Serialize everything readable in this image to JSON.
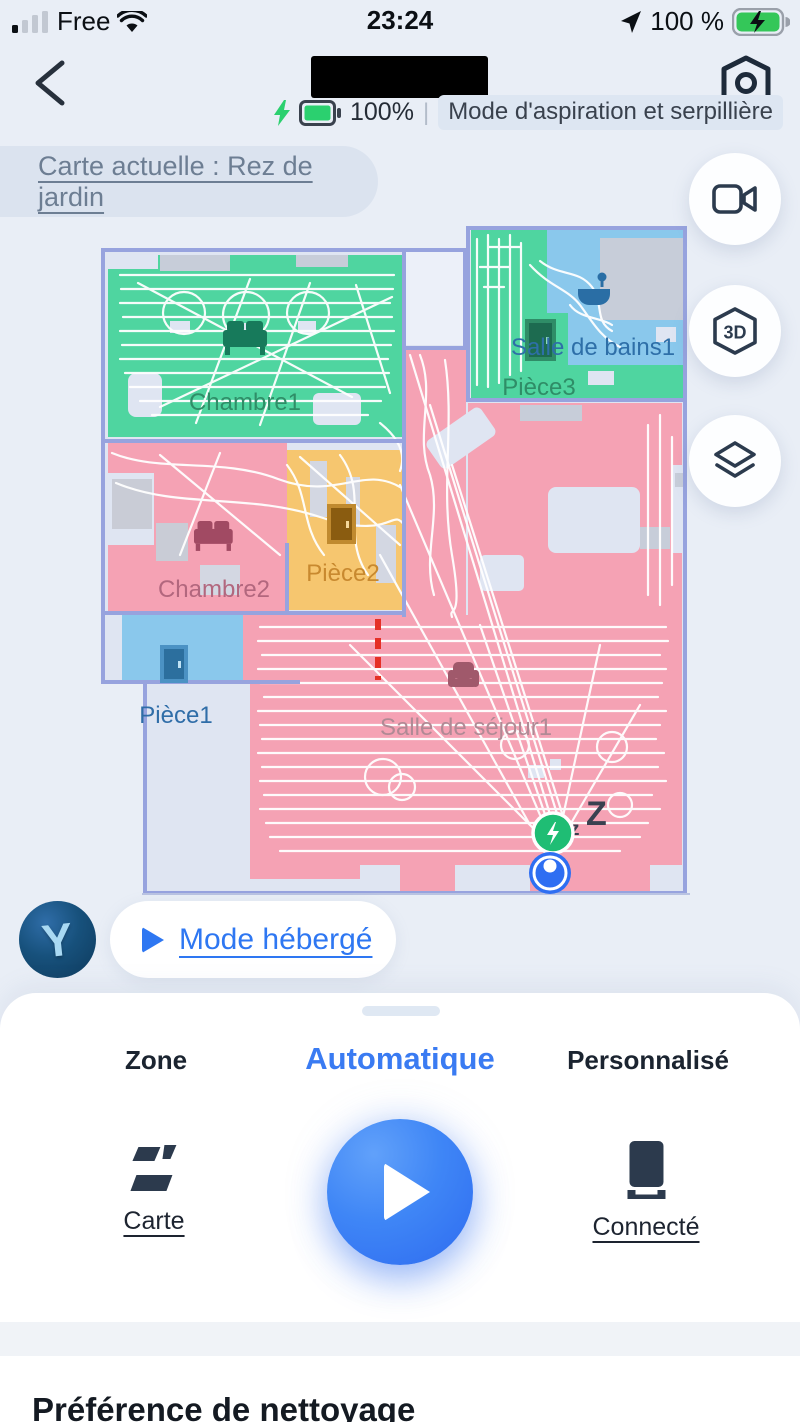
{
  "status_bar": {
    "carrier": "Free",
    "time": "23:24",
    "battery_percent": "100 %"
  },
  "device_header": {
    "battery_label": "100%",
    "mode_label": "Mode d'aspiration et serpillière"
  },
  "map_bar": {
    "current_map_label": "Carte actuelle : Rez de jardin"
  },
  "map": {
    "rooms": [
      {
        "name": "Chambre1",
        "label_color": "#2f8d67",
        "fill": "#4fd5a0"
      },
      {
        "name": "Salle de bains1",
        "label_color": "#2e6fa8",
        "fill": "#8ac8ec"
      },
      {
        "name": "Pièce3",
        "label_color": "#2f8d67",
        "fill": "#4fd5a0"
      },
      {
        "name": "Chambre2",
        "label_color": "#b2677e",
        "fill": "#f5a2b4"
      },
      {
        "name": "Pièce2",
        "label_color": "#c8892f",
        "fill": "#f6c66f"
      },
      {
        "name": "Pièce1",
        "label_color": "#2f6da8",
        "fill": "#8ac8ec"
      },
      {
        "name": "Salle de séjour1",
        "label_color": "#b08a95",
        "fill": "#f5a2b4"
      }
    ],
    "sleep_small": "z",
    "sleep_big": "Z"
  },
  "side_buttons": [
    {
      "name": "video"
    },
    {
      "name": "3d-view",
      "label": "3D"
    },
    {
      "name": "layers"
    }
  ],
  "avatar": {
    "letter": "Y"
  },
  "host_mode": {
    "label": "Mode hébergé"
  },
  "sheet": {
    "tabs": [
      {
        "label": "Zone",
        "active": false
      },
      {
        "label": "Automatique",
        "active": true
      },
      {
        "label": "Personnalisé",
        "active": false
      }
    ],
    "actions": {
      "left_label": "Carte",
      "right_label": "Connecté"
    },
    "section_title": "Préférence de nettoyage"
  },
  "colors": {
    "accent_blue": "#2f6ff2",
    "dock_green": "#1fbd74",
    "map_border": "#97a3de",
    "room_green": "#4fd5a0",
    "room_pink": "#f5a2b4",
    "room_blue": "#8ac8ec",
    "room_yellow": "#f6c66f"
  }
}
